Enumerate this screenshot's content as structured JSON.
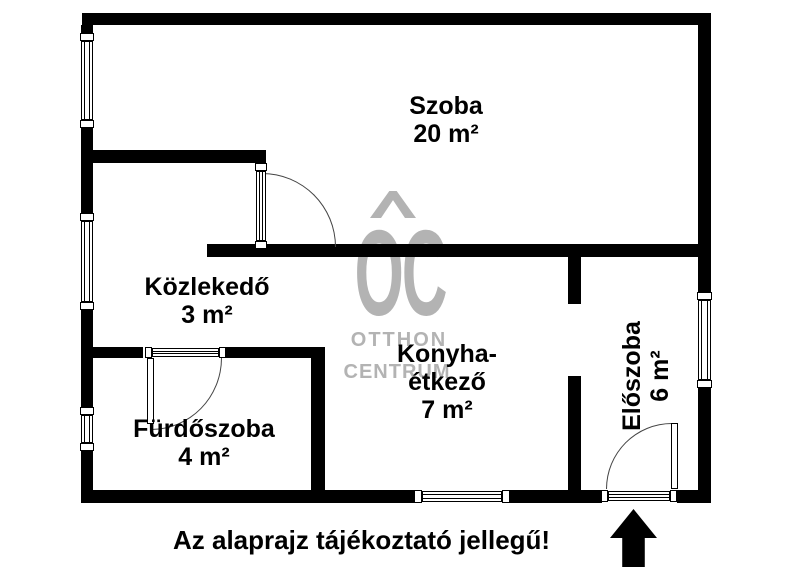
{
  "rooms": {
    "szoba": {
      "name": "Szoba",
      "area": "20 m²"
    },
    "kozlekedo": {
      "name": "Közlekedő",
      "area": "3 m²"
    },
    "furdoszoba": {
      "name": "Fürdőszoba",
      "area": "4 m²"
    },
    "konyha_etkezo": {
      "name_line1": "Konyha-",
      "name_line2": "étkező",
      "area": "7 m²"
    },
    "eloszoba": {
      "name": "Előszoba",
      "area": "6 m²"
    }
  },
  "watermark": {
    "logo_text": "OC",
    "line1": "OTTHON",
    "line2": "CENTRUM",
    "color": "#b3b3b3",
    "roof_icon": "chevron-roof"
  },
  "footer": {
    "disclaimer": "Az alaprajz tájékoztató jellegű!"
  },
  "entrance": {
    "arrow_icon": "up-arrow",
    "arrow_color": "#000000"
  },
  "plan_colors": {
    "walls": "#000000",
    "door_arc": "#444444",
    "background": "#ffffff"
  }
}
